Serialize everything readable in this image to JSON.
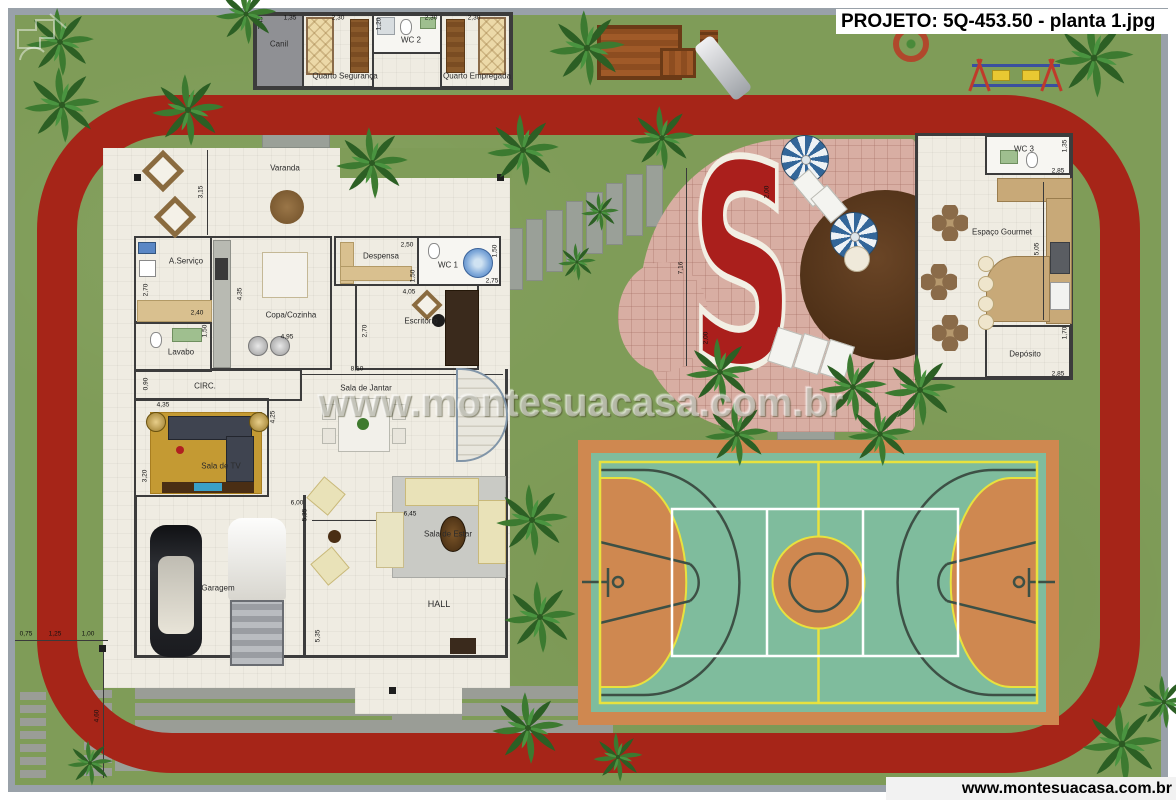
{
  "header": {
    "title": "PROJETO: 5Q-453.50 - planta 1.jpg"
  },
  "watermark": {
    "text": "www.montesuacasa.com.br"
  },
  "footer": {
    "website": "www.montesuacasa.com.br"
  },
  "annex": {
    "canil": {
      "label": "Canil",
      "dim_h": "2,45",
      "dim_w": "1,35"
    },
    "quarto_seguranca": {
      "label": "Quarto Segurança",
      "dim_w": "2,30"
    },
    "wc2": {
      "label": "WC 2",
      "dim_h": "1,20",
      "dim_w": "2,30"
    },
    "quarto_empregada": {
      "label": "Quarto Empregada",
      "dim_w": "2,30"
    }
  },
  "house": {
    "varanda": {
      "label": "Varanda",
      "dim": "3,15"
    },
    "servico": {
      "label": "A.Serviço",
      "dim_h": "2,70",
      "dim_w": "2,40"
    },
    "lavabo": {
      "label": "Lavabo",
      "dim": "1,50"
    },
    "circ": {
      "label": "CIRC.",
      "dim": "0,90"
    },
    "cozinha": {
      "label": "Copa/Cozinha",
      "dim_h": "4,35",
      "dim_w": "4,95"
    },
    "despensa": {
      "label": "Despensa",
      "dim_w": "2,50",
      "dim_h": "1,50"
    },
    "wc1": {
      "label": "WC 1",
      "dim_h": "1,50",
      "dim_w": "2,75"
    },
    "escritorio": {
      "label": "Escritório",
      "dim_w": "4,05",
      "dim_h": "2,70"
    },
    "sala_jantar": {
      "label": "Sala de Jantar",
      "dim_w": "8,10"
    },
    "sala_tv": {
      "label": "Sala de TV",
      "dim_w": "4,35",
      "dim_h": "4,25",
      "dim_h2": "3,20"
    },
    "sala_estar": {
      "label": "Sala de Estar",
      "dim_w": "6,00",
      "dim_h": "5,35",
      "dim_w2": "6,45"
    },
    "hall": {
      "label": "HALL",
      "dim_h": "5,35"
    },
    "garagem": {
      "label": "Garagem"
    }
  },
  "gourmet": {
    "wc3": {
      "label": "WC 3",
      "dim_h": "1,35",
      "dim_w": "2,85"
    },
    "espaco": {
      "label": "Espaço Gourmet",
      "dim_h": "5,05"
    },
    "deposito": {
      "label": "Depósito",
      "dim_h": "1,70",
      "dim_w": "2,85"
    }
  },
  "pool": {
    "dim_h": "7,16",
    "dim_top": "2,00",
    "dim_bottom": "2,00"
  },
  "site": {
    "dims_bottom": [
      "0,75",
      "1,25",
      "1,00"
    ],
    "dim_left": "4,60"
  },
  "colors": {
    "grass": "#7f9c58",
    "track": "#a62518",
    "floor": "#efece2",
    "wall": "#3c3c3c",
    "deck": "#d8aea3",
    "pool": "#aa1f1c",
    "court-orange": "#cf8850",
    "court-green": "#7fbc9d",
    "court-yellow": "#e8e23e"
  }
}
